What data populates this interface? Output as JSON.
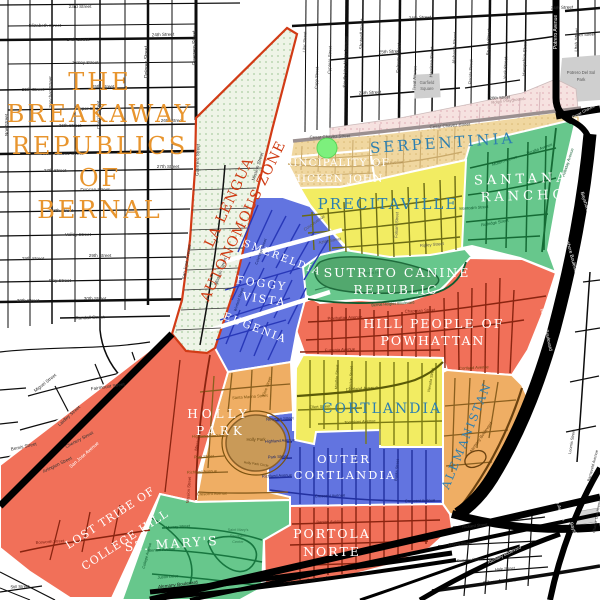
{
  "title": {
    "lines": [
      "THE",
      "BREAKAWAY",
      "REPUBLICS",
      "OF",
      "BERNAL"
    ],
    "color": "#e8952e"
  },
  "la_lengua": {
    "label_lines": [
      "LA LENGUA",
      "AUTONOMOUS ZONE"
    ],
    "text_color": "#cf3a12",
    "fill": "#eef4e7",
    "dot": "#abcda3",
    "border": "#d23b16"
  },
  "north_strip": {
    "fill": "#f6e2e0",
    "dot": "#e4b6bc"
  },
  "marker_color": "#7df07d",
  "regions": {
    "serpentinia": {
      "label": "SERPENTINIA",
      "color": "#f0d7a0",
      "dot": "#d9b873",
      "label_color": "#2d7fb0"
    },
    "chicken_john": {
      "label_lines": [
        "PRINCIPALITY OF",
        "CHICKEN JOHN"
      ],
      "label_color": "#ffffff"
    },
    "precitaville": {
      "label": "PRECITAVILLE",
      "color": "#f2ec62",
      "label_color": "#2d7fb0"
    },
    "santana_rancho": {
      "label_lines": [
        "SANTANA",
        "RANCHO"
      ],
      "color": "#67c78c",
      "label_color": "#ffffff"
    },
    "sutrito": {
      "label_lines": [
        "SUTRITO CANINE",
        "REPUBLIC"
      ],
      "color": "#67c78c",
      "label_color": "#ffffff"
    },
    "powhattan": {
      "label_lines": [
        "HILL PEOPLE OF",
        "POWHATTAN"
      ],
      "color": "#f17059",
      "label_color": "#ffffff"
    },
    "cortlandia": {
      "label": "CORTLANDIA",
      "color": "#f2ec62",
      "label_color": "#2d7fb0"
    },
    "outer_cortlandia": {
      "label_lines": [
        "OUTER",
        "CORTLANDIA"
      ],
      "color": "#6274e0",
      "label_color": "#ffffff"
    },
    "holly_park": {
      "label_lines": [
        "HOLLY",
        "PARK"
      ],
      "color": "#efae64",
      "label_color": "#ffffff"
    },
    "esmereldia": {
      "label": "ESMERELDIA",
      "color": "#6274e0",
      "label_color": "#ffffff"
    },
    "foggy_vista": {
      "label_lines": [
        "FOGGY",
        "VISTA"
      ],
      "label_color": "#ffffff"
    },
    "eugenia": {
      "label": "EUGENIA",
      "label_color": "#ffffff"
    },
    "lost_tribe": {
      "label_lines": [
        "LOST TRIBE OF",
        "COLLEGE HILL"
      ],
      "color": "#f17059",
      "label_color": "#ffffff"
    },
    "st_marys": {
      "label": "ST. MARY'S",
      "color": "#67c78c",
      "label_color": "#ffffff"
    },
    "portola_norte": {
      "label_lines": [
        "PORTOLA",
        "NORTE"
      ],
      "color": "#f17059",
      "label_color": "#ffffff"
    },
    "alemanistan": {
      "label": "ALEMANISTAN",
      "color": "#efae64",
      "label_color": "#2d7fb0"
    }
  },
  "parks": {
    "holly_park_circle": {
      "name": "Holly Park",
      "color": "#c99a58"
    },
    "bernal_hill": {
      "name": "Bernal Hill",
      "color": "#52a86e"
    },
    "garfield": "Garfield Square",
    "potrero_del_sol": "Potrero Del Sol Park",
    "rolph": "Rolph Playground",
    "st_marys_rec": "Saint Mary's Recreation Center"
  },
  "map_labels": [
    {
      "t": "23rd Street",
      "x": 80,
      "y": 8
    },
    {
      "t": "Elizabeth Street",
      "x": 45,
      "y": 27
    },
    {
      "t": "24th Street",
      "x": 78,
      "y": 41
    },
    {
      "t": "24th Street",
      "x": 163,
      "y": 36,
      "r": -2
    },
    {
      "t": "Jersey Street",
      "x": 85,
      "y": 64
    },
    {
      "t": "25th Street",
      "x": 33,
      "y": 91
    },
    {
      "t": "25th Street",
      "x": 103,
      "y": 88
    },
    {
      "t": "Clipper Street",
      "x": 88,
      "y": 110
    },
    {
      "t": "26th Street",
      "x": 70,
      "y": 127
    },
    {
      "t": "26th Street",
      "x": 172,
      "y": 122
    },
    {
      "t": "Cesar Chavez Street",
      "x": 62,
      "y": 155
    },
    {
      "t": "27th Street",
      "x": 55,
      "y": 172
    },
    {
      "t": "27th Street",
      "x": 168,
      "y": 168
    },
    {
      "t": "Duncan Street",
      "x": 95,
      "y": 191
    },
    {
      "t": "28th Street",
      "x": 62,
      "y": 212
    },
    {
      "t": "Valley Street",
      "x": 78,
      "y": 236
    },
    {
      "t": "29th Street",
      "x": 33,
      "y": 260
    },
    {
      "t": "29th Street",
      "x": 100,
      "y": 257
    },
    {
      "t": "Day Street",
      "x": 60,
      "y": 282
    },
    {
      "t": "30th Street",
      "x": 28,
      "y": 302
    },
    {
      "t": "30th Street",
      "x": 95,
      "y": 300
    },
    {
      "t": "Sanchez Street",
      "x": 52,
      "y": 92,
      "r": -90
    },
    {
      "t": "Church Street",
      "x": 100,
      "y": 115,
      "r": -90
    },
    {
      "t": "Dolores Street",
      "x": 148,
      "y": 62,
      "r": -90,
      "s": 5
    },
    {
      "t": "Guerrero Street",
      "x": 196,
      "y": 48,
      "r": -90,
      "s": 5
    },
    {
      "t": "Noe Street",
      "x": 8,
      "y": 125,
      "r": -90
    },
    {
      "t": "Randall Street",
      "x": 90,
      "y": 319,
      "r": -2
    },
    {
      "t": "Fairmount Street",
      "x": 108,
      "y": 388,
      "r": -8
    },
    {
      "t": "Miguel Street",
      "x": 46,
      "y": 384,
      "r": -38
    },
    {
      "t": "Laidley Street",
      "x": 70,
      "y": 417,
      "r": -42
    },
    {
      "t": "Chenery Street",
      "x": 80,
      "y": 441,
      "r": -28
    },
    {
      "t": "Bemis Street",
      "x": 24,
      "y": 448,
      "r": -12
    },
    {
      "t": "Arlington Street",
      "x": 58,
      "y": 466,
      "r": -26
    },
    {
      "t": "San Jose Avenue",
      "x": 85,
      "y": 456,
      "r": -41,
      "s": 4.8,
      "c": "#ffffff"
    },
    {
      "t": "Still Street",
      "x": 20,
      "y": 588,
      "r": -2,
      "s": 4.2
    },
    {
      "t": "Guerrero Street",
      "x": 199,
      "y": 160,
      "r": -88
    },
    {
      "t": "San Jose Avenue",
      "x": 188,
      "y": 262,
      "r": -80
    },
    {
      "t": "Mission Street",
      "x": 259,
      "y": 167,
      "r": -72
    },
    {
      "t": "Mission Street",
      "x": 222,
      "y": 272,
      "r": -70
    },
    {
      "t": "Lilac Street",
      "x": 306,
      "y": 42,
      "r": -88,
      "s": 4.2
    },
    {
      "t": "Capp Street",
      "x": 318,
      "y": 78,
      "r": -88,
      "s": 4.2
    },
    {
      "t": "Cypress Street",
      "x": 331,
      "y": 60,
      "r": -88,
      "s": 4.2
    },
    {
      "t": "South Van Ness Avenue",
      "x": 347,
      "y": 62,
      "r": -88,
      "s": 4.8
    },
    {
      "t": "Shotwell Street",
      "x": 363,
      "y": 34,
      "r": -88
    },
    {
      "t": "Folsom Street",
      "x": 400,
      "y": 58,
      "r": -88,
      "s": 4.8
    },
    {
      "t": "Treat Avenue",
      "x": 416,
      "y": 78,
      "r": -88,
      "s": 4.2
    },
    {
      "t": "Harrison Street",
      "x": 433,
      "y": 62,
      "r": -88
    },
    {
      "t": "Alabama Street",
      "x": 456,
      "y": 48,
      "r": -88
    },
    {
      "t": "Florida Street",
      "x": 472,
      "y": 72,
      "r": -88,
      "s": 4.2
    },
    {
      "t": "Bryant Street",
      "x": 490,
      "y": 42,
      "r": -88
    },
    {
      "t": "York Street",
      "x": 507,
      "y": 68,
      "r": -88
    },
    {
      "t": "Hampshire Street",
      "x": 526,
      "y": 58,
      "r": -88
    },
    {
      "t": "Potrero Avenue",
      "x": 557,
      "y": 32,
      "r": -90,
      "s": 5,
      "c": "#ffffff"
    },
    {
      "t": "Utah Street",
      "x": 578,
      "y": 40,
      "r": -88
    },
    {
      "t": "24th Street",
      "x": 420,
      "y": 19,
      "r": -3
    },
    {
      "t": "24th Street",
      "x": 562,
      "y": 9,
      "r": -3
    },
    {
      "t": "25th Street",
      "x": 390,
      "y": 53,
      "r": -3
    },
    {
      "t": "25th Street",
      "x": 585,
      "y": 36,
      "r": -3,
      "s": 4.2
    },
    {
      "t": "26th Street",
      "x": 370,
      "y": 94,
      "r": -3
    },
    {
      "t": "26th Street",
      "x": 500,
      "y": 99,
      "r": -4,
      "s": 4.2
    },
    {
      "t": "Garfield",
      "x": 427,
      "y": 84,
      "s": 4.2,
      "c": "#666666"
    },
    {
      "t": "Square",
      "x": 427,
      "y": 90,
      "s": 4.2,
      "c": "#666666"
    },
    {
      "t": "Potrero Del Sol",
      "x": 581,
      "y": 74,
      "s": 4.2,
      "c": "#555555"
    },
    {
      "t": "Park",
      "x": 581,
      "y": 81,
      "s": 4.2,
      "c": "#555555"
    },
    {
      "t": "Rolph Playground",
      "x": 508,
      "y": 102,
      "r": -7,
      "s": 4.2,
      "c": "#b09090"
    },
    {
      "t": "Cesar Chavez Street",
      "x": 330,
      "y": 138,
      "r": -2,
      "s": 4.4,
      "c": "#555555"
    },
    {
      "t": "Cesar Chavez Street",
      "x": 450,
      "y": 127,
      "r": -4,
      "s": 4.4,
      "c": "#555555"
    },
    {
      "t": "Cesar Chavez Street",
      "x": 589,
      "y": 110,
      "r": -28,
      "s": 4,
      "c": "#ffffff"
    },
    {
      "t": "Precita Avenue",
      "x": 390,
      "y": 164,
      "r": -4,
      "s": 4,
      "c": "#a8854a"
    },
    {
      "t": "Coso Avenue",
      "x": 315,
      "y": 224,
      "r": -35,
      "s": 4.2,
      "c": "#555555"
    },
    {
      "t": "Aztec Street",
      "x": 330,
      "y": 242,
      "r": -10,
      "s": 4.2,
      "c": "#555555"
    },
    {
      "t": "Folsom Street",
      "x": 398,
      "y": 225,
      "r": -88,
      "s": 4.2,
      "c": "#555555"
    },
    {
      "t": "Ripley Street",
      "x": 432,
      "y": 246,
      "r": -5,
      "s": 4.2,
      "c": "#555555"
    },
    {
      "t": "Mullen Avenue",
      "x": 505,
      "y": 162,
      "r": -18,
      "s": 4,
      "c": "#0e5c30"
    },
    {
      "t": "Peralta Avenue",
      "x": 540,
      "y": 150,
      "r": -20,
      "s": 4,
      "c": "#0e5c30"
    },
    {
      "t": "Montcalm Street",
      "x": 474,
      "y": 209,
      "r": -4,
      "s": 4,
      "c": "#0e5c30"
    },
    {
      "t": "Rutledge Street",
      "x": 495,
      "y": 224,
      "r": -10,
      "s": 4,
      "c": "#0e5c30"
    },
    {
      "t": "Holladay Avenue",
      "x": 569,
      "y": 163,
      "r": -72,
      "s": 4,
      "c": "#0e5c30"
    },
    {
      "t": "Bernal Heights Boulevard",
      "x": 393,
      "y": 305,
      "r": -4,
      "s": 3.8,
      "c": "#0e5c30"
    },
    {
      "t": "Bernal Hill",
      "x": 372,
      "y": 274,
      "r": -4,
      "s": 3.8,
      "c": "#2f7d4f"
    },
    {
      "t": "Powhattan Avenue",
      "x": 345,
      "y": 319,
      "r": -3,
      "s": 4.2,
      "c": "#7a1f10"
    },
    {
      "t": "Chapman Street",
      "x": 420,
      "y": 312,
      "r": -3,
      "s": 4.2,
      "c": "#7a1f10"
    },
    {
      "t": "Eugenia Avenue",
      "x": 340,
      "y": 351,
      "r": -3,
      "s": 4.2,
      "c": "#7a1f10"
    },
    {
      "t": "Cortland Avenue",
      "x": 362,
      "y": 390,
      "r": -4,
      "s": 4.4,
      "c": "#55550a"
    },
    {
      "t": "Ellert Street",
      "x": 320,
      "y": 408,
      "r": -3,
      "s": 4,
      "c": "#55550a"
    },
    {
      "t": "Tompkins Avenue",
      "x": 360,
      "y": 423,
      "r": -3,
      "s": 4,
      "c": "#55550a"
    },
    {
      "t": "Moultrie Street",
      "x": 338,
      "y": 377,
      "r": -87,
      "s": 3.8,
      "c": "#55550a"
    },
    {
      "t": "Anderson Street",
      "x": 352,
      "y": 380,
      "r": -87,
      "s": 3.8,
      "c": "#55550a"
    },
    {
      "t": "Nevada Street",
      "x": 432,
      "y": 380,
      "r": -80,
      "s": 3.8,
      "c": "#55550a"
    },
    {
      "t": "Newman Street",
      "x": 280,
      "y": 420,
      "r": -3,
      "s": 4,
      "c": "#18246e"
    },
    {
      "t": "Highland Avenue",
      "x": 280,
      "y": 442,
      "r": -3,
      "s": 4,
      "c": "#18246e"
    },
    {
      "t": "Park Street",
      "x": 278,
      "y": 458,
      "r": -3,
      "s": 4,
      "c": "#18246e"
    },
    {
      "t": "Richland Avenue",
      "x": 277,
      "y": 477,
      "r": -3,
      "s": 4,
      "c": "#18246e"
    },
    {
      "t": "Crescent Avenue",
      "x": 330,
      "y": 497,
      "r": -2,
      "s": 4,
      "c": "#18246e"
    },
    {
      "t": "Crescent Avenue",
      "x": 420,
      "y": 502,
      "r": -2,
      "s": 4,
      "c": "#18246e"
    },
    {
      "t": "Banks Street",
      "x": 398,
      "y": 470,
      "r": -85,
      "s": 3.8,
      "c": "#18246e"
    },
    {
      "t": "Santa Marina Street",
      "x": 250,
      "y": 398,
      "r": -4,
      "s": 4,
      "c": "#7a5210"
    },
    {
      "t": "Elsie Street",
      "x": 268,
      "y": 387,
      "r": -70,
      "s": 4,
      "c": "#7a5210"
    },
    {
      "t": "Highland Avenue",
      "x": 207,
      "y": 437,
      "r": -3,
      "s": 4,
      "c": "#7a5210"
    },
    {
      "t": "Park Street",
      "x": 204,
      "y": 458,
      "r": -3,
      "s": 4,
      "c": "#7a5210"
    },
    {
      "t": "Richland Avenue",
      "x": 202,
      "y": 473,
      "r": -3,
      "s": 4,
      "c": "#7a5210"
    },
    {
      "t": "Crescent Avenue",
      "x": 212,
      "y": 495,
      "r": -2,
      "s": 4,
      "c": "#7a5210"
    },
    {
      "t": "Holly Park",
      "x": 256,
      "y": 441,
      "s": 4.2,
      "c": "#6b4a14"
    },
    {
      "t": "Holly Park Circle",
      "x": 256,
      "y": 465,
      "r": 8,
      "s": 3.4,
      "c": "#6b4a14"
    },
    {
      "t": "Coleridge Street",
      "x": 262,
      "y": 252,
      "r": -70,
      "s": 3.8,
      "c": "#15246b"
    },
    {
      "t": "Winfield Street",
      "x": 240,
      "y": 300,
      "r": -72,
      "s": 3.8,
      "c": "#15246b"
    },
    {
      "t": "Bosworth Street",
      "x": 50,
      "y": 543,
      "r": -4,
      "s": 4,
      "c": "#7a1f10"
    },
    {
      "t": "Mission Street",
      "x": 200,
      "y": 438,
      "r": -78,
      "s": 4.2,
      "c": "#7a1f10"
    },
    {
      "t": "Mission Street",
      "x": 190,
      "y": 490,
      "r": -85,
      "s": 4.2,
      "c": "#7a1f10"
    },
    {
      "t": "Murray Street",
      "x": 178,
      "y": 528,
      "r": -4,
      "s": 4,
      "c": "#0e5c30"
    },
    {
      "t": "Benton Avenue",
      "x": 162,
      "y": 551,
      "r": -4,
      "s": 4,
      "c": "#0e5c30"
    },
    {
      "t": "Justin Drive",
      "x": 168,
      "y": 578,
      "r": -4,
      "s": 4,
      "c": "#0e5c30"
    },
    {
      "t": "College Avenue",
      "x": 148,
      "y": 556,
      "r": -75,
      "s": 3.8,
      "c": "#0e5c30"
    },
    {
      "t": "Saint Mary's",
      "x": 238,
      "y": 531,
      "s": 3.8,
      "c": "#2f7d4f"
    },
    {
      "t": "Recreation",
      "x": 239,
      "y": 537,
      "s": 3.8,
      "c": "#2f7d4f"
    },
    {
      "t": "Center",
      "x": 238,
      "y": 543,
      "s": 3.8,
      "c": "#2f7d4f"
    },
    {
      "t": "Benton Avenue",
      "x": 330,
      "y": 523,
      "r": -2,
      "s": 4,
      "c": "#7a1f10"
    },
    {
      "t": "Cortland Avenue",
      "x": 474,
      "y": 369,
      "r": -3,
      "s": 4,
      "c": "#6b4210"
    },
    {
      "t": "Alemany Boulevard",
      "x": 482,
      "y": 438,
      "r": -55,
      "s": 4.2,
      "c": "#6b4210"
    },
    {
      "t": "Alemany Boulevard",
      "x": 505,
      "y": 556,
      "r": -26,
      "s": 4.2,
      "c": "#ffffff"
    },
    {
      "t": "Bayshore Boulevard",
      "x": 587,
      "y": 213,
      "r": 73,
      "s": 4.8,
      "c": "#ffffff"
    },
    {
      "t": "Bayshore Boulevard",
      "x": 570,
      "y": 255,
      "r": 75,
      "s": 4.8,
      "c": "#ffffff"
    },
    {
      "t": "Bayshore Boulevard",
      "x": 545,
      "y": 330,
      "r": 78,
      "s": 4.8,
      "c": "#ffffff"
    },
    {
      "t": "Bayshore Boulevard",
      "x": 577,
      "y": 543,
      "r": 70,
      "s": 4.8,
      "c": "#ffffff"
    },
    {
      "t": "San Bruno Avenue",
      "x": 556,
      "y": 502,
      "r": 72,
      "s": 4.8,
      "c": "#ffffff"
    },
    {
      "t": "Loomis Street",
      "x": 573,
      "y": 442,
      "r": -80,
      "s": 4,
      "c": "#333333"
    },
    {
      "t": "Barneveld Avenue",
      "x": 594,
      "y": 466,
      "r": -75,
      "s": 4,
      "c": "#333333"
    },
    {
      "t": "Charter Oak Avenue",
      "x": 598,
      "y": 516,
      "r": -80,
      "s": 3.8,
      "c": "#333333"
    },
    {
      "t": "Rickard Street",
      "x": 475,
      "y": 527,
      "r": -6,
      "s": 4,
      "c": "#333333"
    },
    {
      "t": "Gaven Street",
      "x": 460,
      "y": 545,
      "r": -5,
      "s": 4,
      "c": "#333333"
    },
    {
      "t": "Sweeny Street",
      "x": 470,
      "y": 561,
      "r": -5,
      "s": 4,
      "c": "#333333"
    },
    {
      "t": "Hale Street",
      "x": 505,
      "y": 570,
      "r": -4,
      "s": 4,
      "c": "#333333"
    },
    {
      "t": "Silver Avenue",
      "x": 500,
      "y": 583,
      "r": -7,
      "s": 5.5,
      "c": "#111111"
    },
    {
      "t": "Alemany Boulevard",
      "x": 178,
      "y": 586,
      "r": -7,
      "s": 4.6,
      "c": "#111111"
    },
    {
      "t": "Alemany Boulevard",
      "x": 308,
      "y": 582,
      "r": -8,
      "s": 4.6,
      "c": "#111111"
    },
    {
      "t": "Alemany Boulevard",
      "x": 315,
      "y": 594,
      "r": -8,
      "s": 4.6,
      "c": "#ffffff"
    }
  ]
}
